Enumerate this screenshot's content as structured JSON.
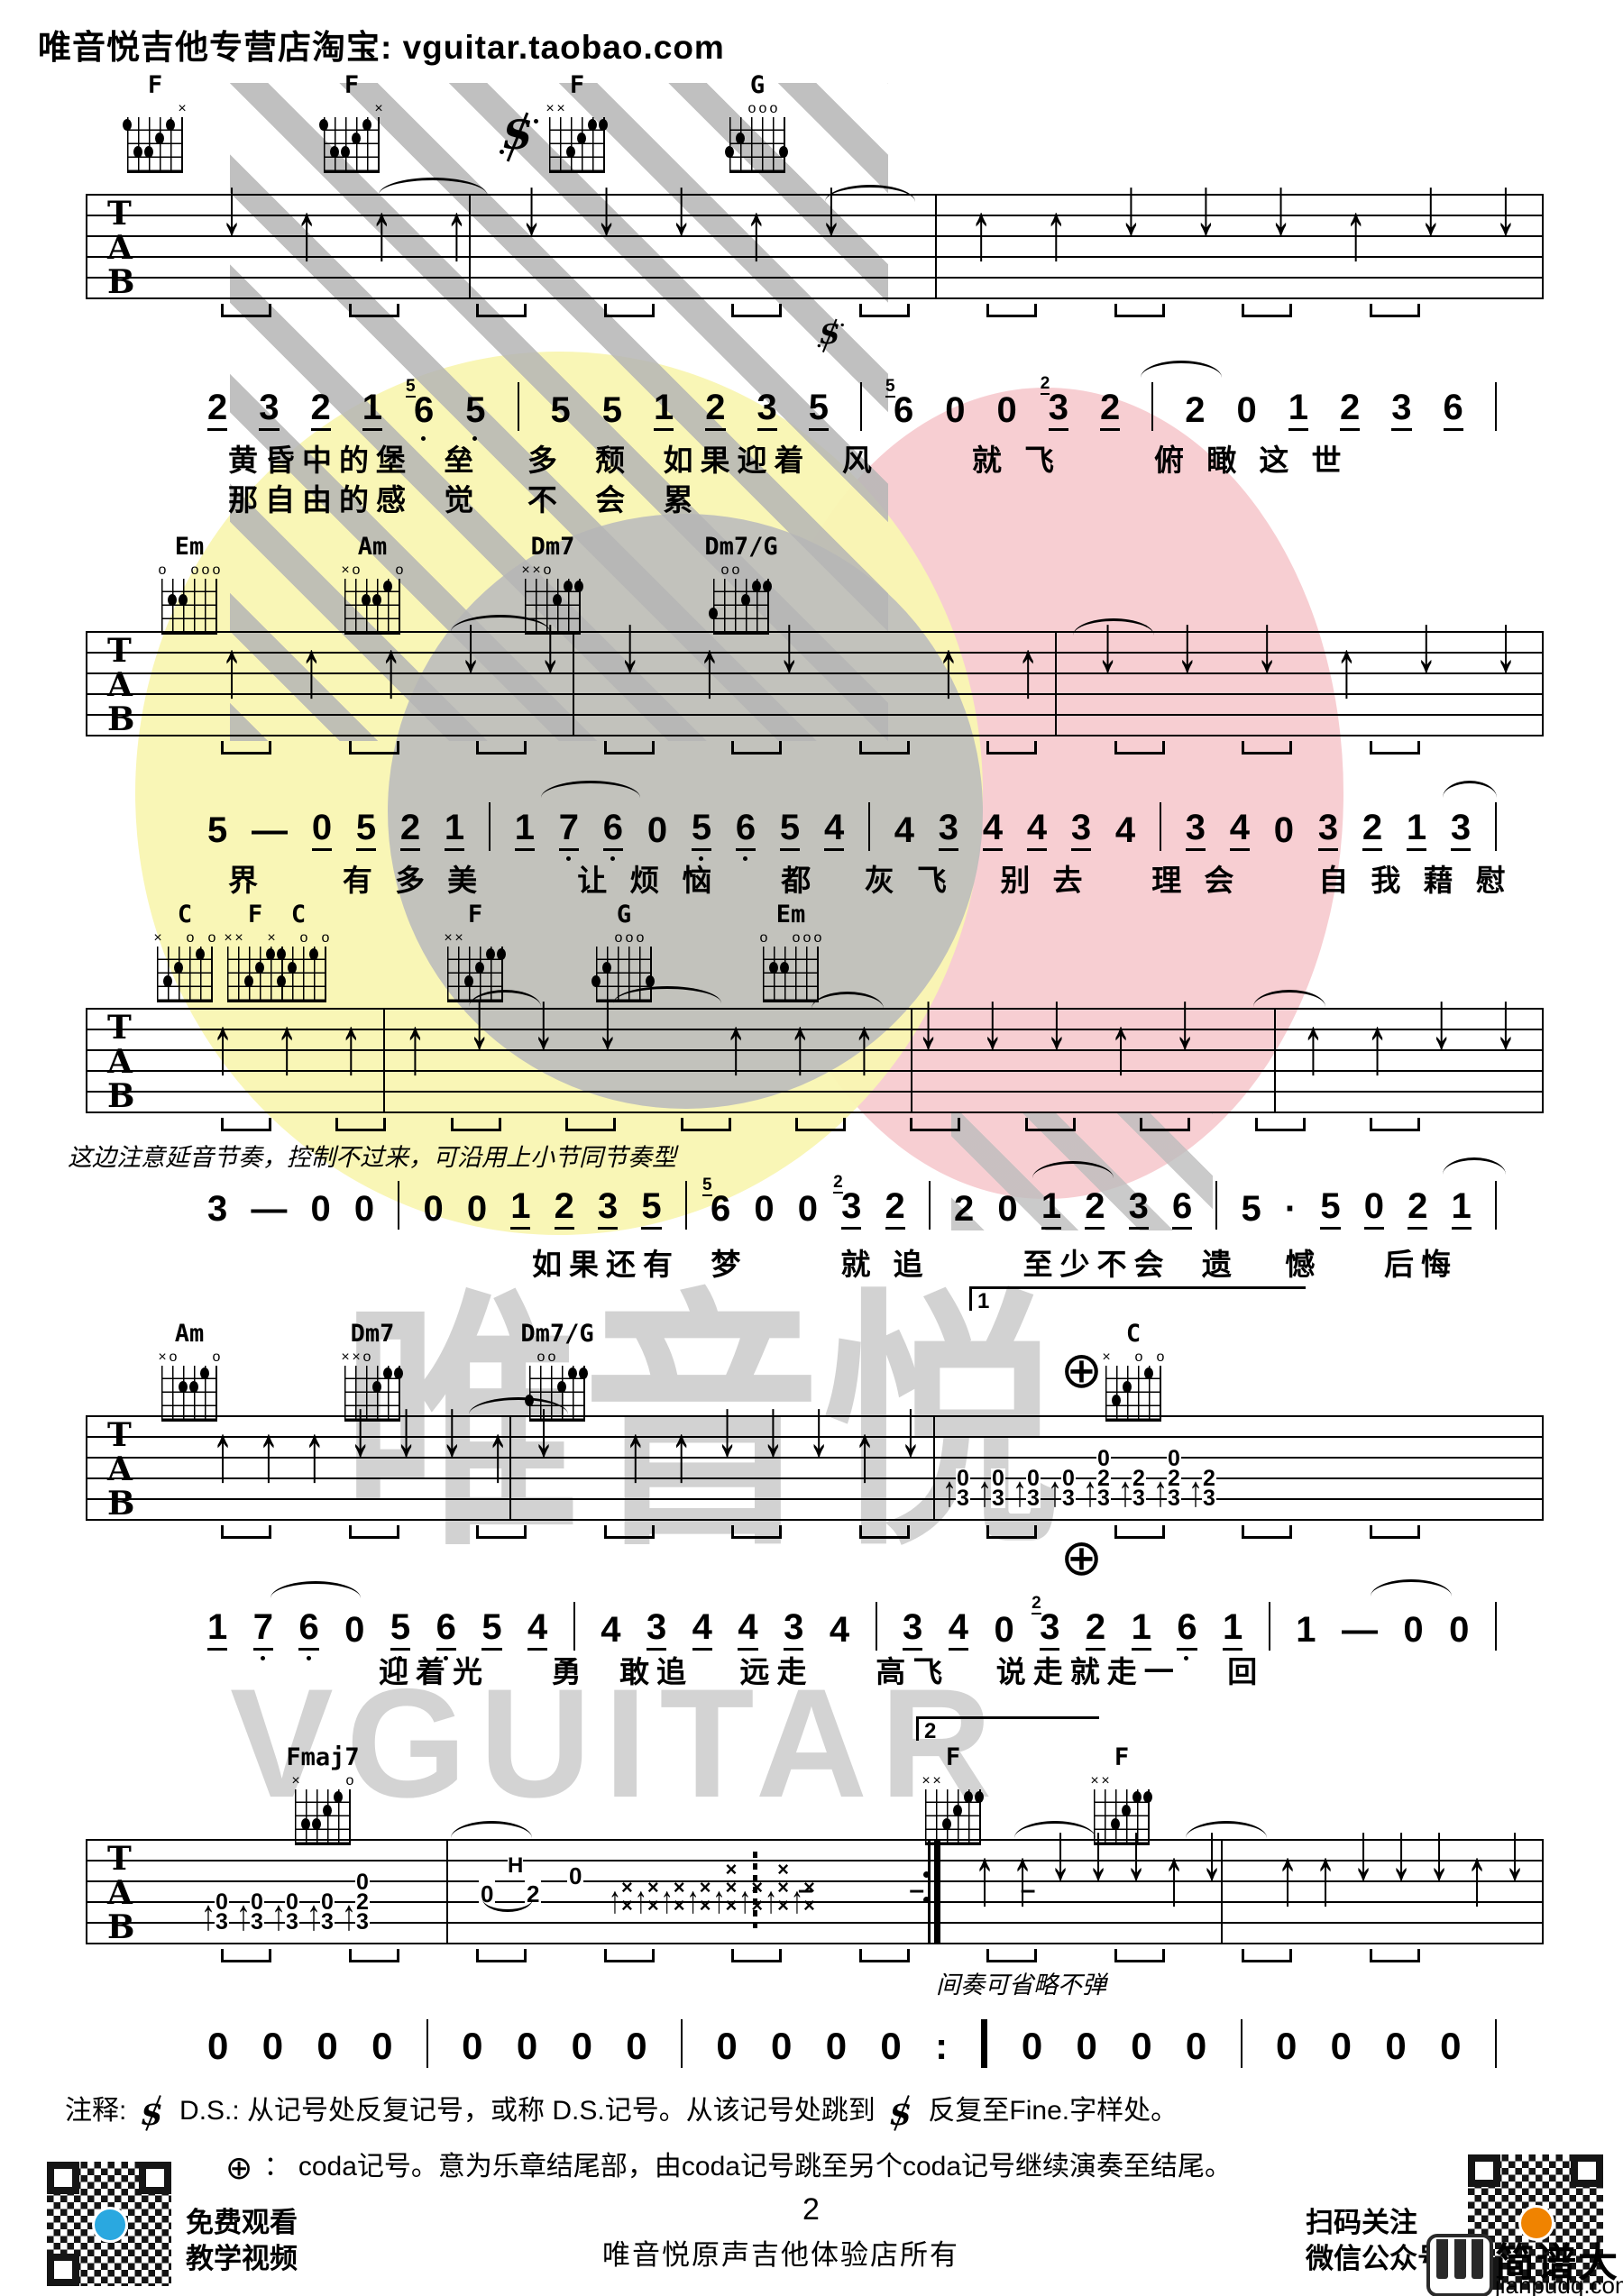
{
  "header": {
    "store_line": "唯音悦吉他专营店淘宝: vguitar.taobao.com"
  },
  "staff_letters": [
    "T",
    "A",
    "B"
  ],
  "chord_rows": [
    [
      "F",
      "F",
      "F",
      "G"
    ],
    [
      "Em",
      "Am",
      "Dm7",
      "Dm7/G"
    ],
    [
      "C",
      "F",
      "C",
      "F",
      "G",
      "Em"
    ],
    [
      "Am",
      "Dm7",
      "Dm7/G",
      "C"
    ],
    [
      "Fmaj7",
      "F",
      "F"
    ]
  ],
  "shapes": {
    "F1": {
      "marks": [
        [
          5,
          "×"
        ]
      ],
      "dots": [
        [
          0,
          1
        ],
        [
          4,
          1
        ],
        [
          3,
          2
        ],
        [
          1,
          3
        ],
        [
          2,
          3
        ]
      ]
    },
    "F2": {
      "marks": [
        [
          0,
          "×"
        ],
        [
          1,
          "×"
        ]
      ],
      "dots": [
        [
          4,
          1
        ],
        [
          5,
          1
        ],
        [
          3,
          2
        ],
        [
          2,
          3
        ]
      ]
    },
    "G": {
      "marks": [
        [
          2,
          "o"
        ],
        [
          3,
          "o"
        ],
        [
          4,
          "o"
        ]
      ],
      "dots": [
        [
          1,
          2
        ],
        [
          0,
          3
        ],
        [
          5,
          3
        ]
      ]
    },
    "Em": {
      "marks": [
        [
          0,
          "o"
        ],
        [
          3,
          "o"
        ],
        [
          4,
          "o"
        ],
        [
          5,
          "o"
        ]
      ],
      "dots": [
        [
          1,
          2
        ],
        [
          2,
          2
        ]
      ]
    },
    "Am": {
      "marks": [
        [
          0,
          "×"
        ],
        [
          1,
          "o"
        ],
        [
          5,
          "o"
        ]
      ],
      "dots": [
        [
          4,
          1
        ],
        [
          2,
          2
        ],
        [
          3,
          2
        ]
      ]
    },
    "Dm7": {
      "marks": [
        [
          0,
          "×"
        ],
        [
          1,
          "×"
        ],
        [
          2,
          "o"
        ]
      ],
      "dots": [
        [
          4,
          1
        ],
        [
          5,
          1
        ],
        [
          3,
          2
        ]
      ]
    },
    "Dm7G": {
      "marks": [
        [
          1,
          "o"
        ],
        [
          2,
          "o"
        ]
      ],
      "dots": [
        [
          4,
          1
        ],
        [
          5,
          1
        ],
        [
          3,
          2
        ],
        [
          0,
          3
        ]
      ]
    },
    "C": {
      "marks": [
        [
          0,
          "×"
        ],
        [
          3,
          "o"
        ],
        [
          5,
          "o"
        ]
      ],
      "dots": [
        [
          4,
          1
        ],
        [
          2,
          2
        ],
        [
          1,
          3
        ]
      ]
    },
    "Fmaj7": {
      "marks": [
        [
          0,
          "×"
        ],
        [
          5,
          "o"
        ]
      ],
      "dots": [
        [
          4,
          1
        ],
        [
          3,
          2
        ],
        [
          2,
          3
        ],
        [
          1,
          3
        ]
      ]
    }
  },
  "melody": {
    "m1": [
      {
        "d": "2",
        "u": 1
      },
      {
        "d": "3",
        "u": 1
      },
      {
        "d": "2",
        "u": 1
      },
      {
        "d": "1",
        "u": 1
      },
      {
        "d": "6",
        "b": 1,
        "a": "5"
      },
      {
        "d": "5",
        "b": 1
      },
      {
        "bar": 1
      },
      {
        "d": "5"
      },
      {
        "d": "5"
      },
      {
        "d": "1",
        "u": 1
      },
      {
        "d": "2",
        "u": 1
      },
      {
        "d": "3",
        "u": 1
      },
      {
        "d": "5",
        "u": 1
      },
      {
        "bar": 1
      },
      {
        "d": "6",
        "a": "5"
      },
      {
        "d": "0"
      },
      {
        "d": "0"
      },
      {
        "d": "3",
        "u": 1,
        "a": "2"
      },
      {
        "d": "2",
        "u": 1
      },
      {
        "bar": 1
      },
      {
        "d": "2"
      },
      {
        "d": "0"
      },
      {
        "d": "1",
        "u": 1
      },
      {
        "d": "2",
        "u": 1
      },
      {
        "d": "3",
        "u": 1
      },
      {
        "d": "6",
        "u": 1
      },
      {
        "bar": 1
      }
    ],
    "m2": [
      {
        "d": "5"
      },
      {
        "d": "—"
      },
      {
        "d": "0",
        "u": 1
      },
      {
        "d": "5",
        "u": 1
      },
      {
        "d": "2",
        "u": 1
      },
      {
        "d": "1",
        "u": 1
      },
      {
        "bar": 1
      },
      {
        "d": "1",
        "u": 1
      },
      {
        "d": "7",
        "u": 1,
        "b": 1
      },
      {
        "d": "6",
        "u": 1,
        "b": 1
      },
      {
        "d": "0"
      },
      {
        "d": "5",
        "u": 1,
        "b": 1
      },
      {
        "d": "6",
        "u": 1,
        "b": 1
      },
      {
        "d": "5",
        "u": 1
      },
      {
        "d": "4",
        "u": 1
      },
      {
        "bar": 1
      },
      {
        "d": "4"
      },
      {
        "d": "3",
        "u": 1
      },
      {
        "d": "4",
        "u": 1
      },
      {
        "d": "4",
        "u": 1
      },
      {
        "d": "3",
        "u": 1
      },
      {
        "d": "4"
      },
      {
        "bar": 1
      },
      {
        "d": "3",
        "u": 1
      },
      {
        "d": "4",
        "u": 1
      },
      {
        "d": "0"
      },
      {
        "d": "3",
        "u": 1
      },
      {
        "d": "2",
        "u": 1
      },
      {
        "d": "1",
        "u": 1
      },
      {
        "d": "3",
        "u": 1
      },
      {
        "bar": 1
      }
    ],
    "m3": [
      {
        "d": "3"
      },
      {
        "d": "—"
      },
      {
        "d": "0"
      },
      {
        "d": "0"
      },
      {
        "bar": 1
      },
      {
        "d": "0"
      },
      {
        "d": "0"
      },
      {
        "d": "1",
        "u": 1
      },
      {
        "d": "2",
        "u": 1
      },
      {
        "d": "3",
        "u": 1
      },
      {
        "d": "5",
        "u": 1
      },
      {
        "bar": 1
      },
      {
        "d": "6",
        "a": "5"
      },
      {
        "d": "0"
      },
      {
        "d": "0"
      },
      {
        "d": "3",
        "u": 1,
        "a": "2"
      },
      {
        "d": "2",
        "u": 1
      },
      {
        "bar": 1
      },
      {
        "d": "2"
      },
      {
        "d": "0"
      },
      {
        "d": "1",
        "u": 1
      },
      {
        "d": "2",
        "u": 1
      },
      {
        "d": "3",
        "u": 1
      },
      {
        "d": "6",
        "u": 1
      },
      {
        "bar": 1
      },
      {
        "d": "5"
      },
      {
        "d": "·"
      },
      {
        "d": "5",
        "u": 1
      },
      {
        "d": "0",
        "u": 1
      },
      {
        "d": "2",
        "u": 1
      },
      {
        "d": "1",
        "u": 1
      },
      {
        "bar": 1
      }
    ],
    "m4": [
      {
        "d": "1",
        "u": 1
      },
      {
        "d": "7",
        "u": 1,
        "b": 1
      },
      {
        "d": "6",
        "u": 1,
        "b": 1
      },
      {
        "d": "0"
      },
      {
        "d": "5",
        "u": 1,
        "b": 1
      },
      {
        "d": "6",
        "u": 1,
        "b": 1
      },
      {
        "d": "5",
        "u": 1
      },
      {
        "d": "4",
        "u": 1
      },
      {
        "bar": 1
      },
      {
        "d": "4"
      },
      {
        "d": "3",
        "u": 1
      },
      {
        "d": "4",
        "u": 1
      },
      {
        "d": "4",
        "u": 1
      },
      {
        "d": "3",
        "u": 1
      },
      {
        "d": "4"
      },
      {
        "bar": 1
      },
      {
        "d": "3",
        "u": 1
      },
      {
        "d": "4",
        "u": 1
      },
      {
        "d": "0"
      },
      {
        "d": "3",
        "u": 1,
        "a": "2"
      },
      {
        "d": "2",
        "u": 1
      },
      {
        "d": "1",
        "u": 1
      },
      {
        "d": "6",
        "u": 1,
        "b": 1
      },
      {
        "d": "1",
        "u": 1
      },
      {
        "bar": 1
      },
      {
        "d": "1"
      },
      {
        "d": "—"
      },
      {
        "d": "0"
      },
      {
        "d": "0"
      },
      {
        "bar": 1
      }
    ],
    "m5": [
      {
        "d": "0"
      },
      {
        "d": "0"
      },
      {
        "d": "0"
      },
      {
        "d": "0"
      },
      {
        "bar": 1
      },
      {
        "d": "0"
      },
      {
        "d": "0"
      },
      {
        "d": "0"
      },
      {
        "d": "0"
      },
      {
        "bar": 1
      },
      {
        "d": "0"
      },
      {
        "d": "0"
      },
      {
        "d": "0"
      },
      {
        "d": "0"
      },
      {
        "d": ":"
      },
      {
        "bar": 1,
        "thick": 1
      },
      {
        "d": "0"
      },
      {
        "d": "0"
      },
      {
        "d": "0"
      },
      {
        "d": "0"
      },
      {
        "bar": 1
      },
      {
        "d": "0"
      },
      {
        "d": "0"
      },
      {
        "d": "0"
      },
      {
        "d": "0"
      },
      {
        "bar": 1
      }
    ]
  },
  "lyrics": {
    "l1a": "黄昏中的堡  垒   多  颓  如果迎着  风      就 飞      俯 瞰 这 世",
    "l1b": "那自由的感  觉   不  会  累",
    "l2": "界     有 多 美      让 烦 恼    都   灰 飞   别 去    理 会     自 我 藉 慰",
    "l3": "如果还有  梦      就 追      至少不会  遗   憾    后悔",
    "l4": "迎着光    勇  敢追   远走    高飞   说走就走一   回"
  },
  "strums": {
    "s1": "duuudddud uudddudd",
    "s2": "uuudddud uudddudd",
    "s3": "uuuuddd uuudddud uudd",
    "s4": "uuudddud uudddud",
    "s5": "uudddud uudddud"
  },
  "tabs": {
    "s4": [
      {
        "m": "0",
        "b": "3"
      },
      {
        "m": "0",
        "b": "3"
      },
      {
        "m": "0",
        "b": "3"
      },
      {
        "m": "0",
        "b": "3"
      },
      {
        "t": "0",
        "m": "2",
        "b": "3"
      },
      {
        "m": "2",
        "b": "3"
      },
      {
        "t": "0",
        "m": "2",
        "b": "3"
      },
      {
        "m": "2",
        "b": "3"
      }
    ],
    "s5a": [
      {
        "m": "0",
        "b": "3"
      },
      {
        "m": "0",
        "b": "3"
      },
      {
        "m": "0",
        "b": "3"
      },
      {
        "m": "0",
        "b": "3"
      },
      {
        "t": "0",
        "m": "2",
        "b": "3"
      }
    ],
    "s5muted": [
      "××",
      "××",
      "××",
      "××",
      "×××",
      "××",
      "×××",
      "××"
    ],
    "hammer": {
      "h": "H",
      "n1": "0",
      "n2": "2",
      "n3": "0"
    },
    "rests": "–  –  –"
  },
  "voltas": {
    "v1": "1",
    "v2": "2"
  },
  "symbols": {
    "coda": "⊕"
  },
  "annotations": {
    "sustain_note": "这边注意延音节奏，控制不过来，可沿用上小节同节奏型",
    "interlude_note": "间奏可省略不弹"
  },
  "notes": {
    "label": "注释:",
    "ds_pre": "D.S.: 从记号处反复记号，或称 D.S.记号。从该记号处跳到",
    "ds_post": "反复至Fine.字样处。",
    "coda_sep": "：",
    "coda_text": "coda记号。意为乐章结尾部，由coda记号跳至另个coda记号继续演奏至结尾。"
  },
  "watermark": {
    "cn": "唯音悦",
    "en": "VGUITAR"
  },
  "footer": {
    "page": "2",
    "watch1": "免费观看",
    "watch2": "教学视频",
    "owner": "唯音悦原声吉他体验店所有",
    "scan1": "扫码关注",
    "scan2": "微信公众号",
    "brand_name": "简谱大全",
    "brand_domain": "jianpudq.com"
  }
}
